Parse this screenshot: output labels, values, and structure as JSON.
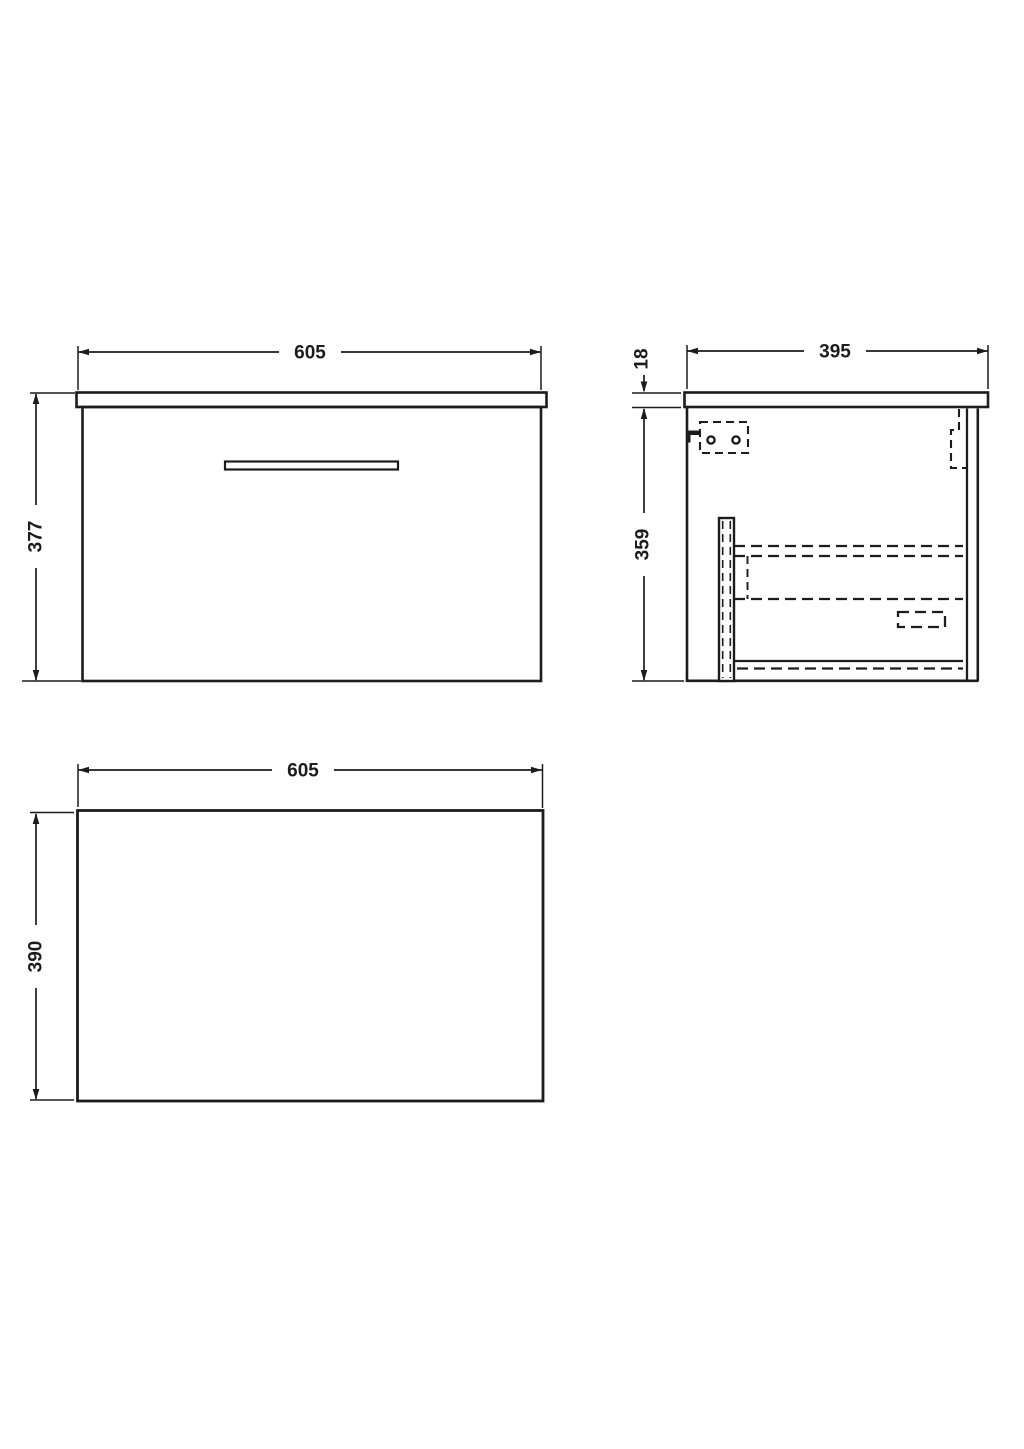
{
  "drawing": {
    "subject": "wall-hung-vanity-unit-technical-drawing",
    "colors": {
      "line": "#1c1c1c",
      "background": "#ffffff"
    },
    "views": {
      "front": {
        "name": "front-view",
        "dims": {
          "width": "605",
          "height": "377"
        }
      },
      "side": {
        "name": "side-view",
        "dims": {
          "depth": "395",
          "worktop_thickness": "18",
          "body_height": "359"
        }
      },
      "plan": {
        "name": "plan-view",
        "dims": {
          "width": "605",
          "depth": "390"
        }
      }
    }
  }
}
